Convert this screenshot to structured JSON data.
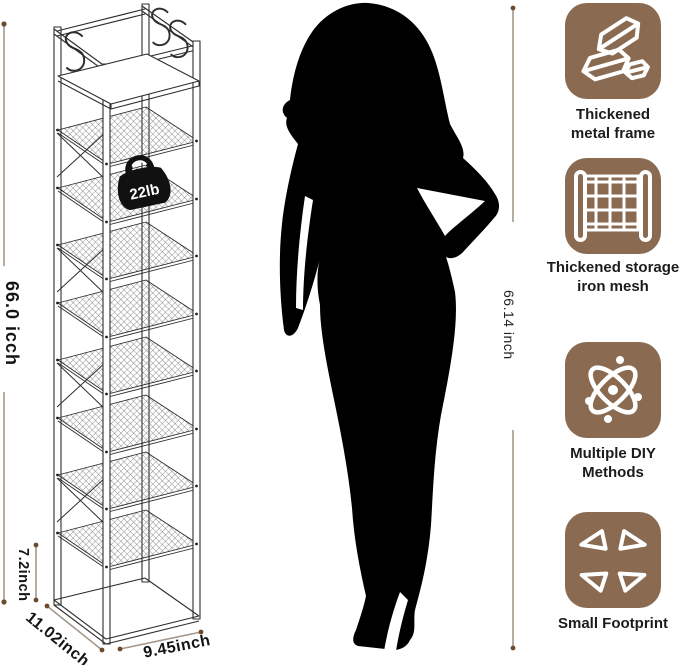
{
  "rack": {
    "weight_capacity_badge": "22lb",
    "dim_height": "66.0 icch",
    "dim_shelf_gap": "7.2inch",
    "dim_depth": "11.02inch",
    "dim_width": "9.45inch"
  },
  "person": {
    "height_label": "66.14 inch"
  },
  "features": [
    {
      "icon": "gold-bars-icon",
      "line1": "Thickened",
      "line2": "metal frame"
    },
    {
      "icon": "iron-mesh-icon",
      "line1": "Thickened storage",
      "line2": "iron mesh"
    },
    {
      "icon": "atom-icon",
      "line1": "Multiple DIY",
      "line2": "Methods"
    },
    {
      "icon": "expand-arrows-icon",
      "line1": "Small Footprint",
      "line2": ""
    }
  ],
  "colors": {
    "feature_tile": "#8a6a50",
    "dimension_line": "#a5988b",
    "dimension_dot": "#6b4a2e",
    "line_art": "#2e2e2e",
    "silhouette": "#000000",
    "badge": "#111111",
    "text": "#1c1c1c"
  }
}
